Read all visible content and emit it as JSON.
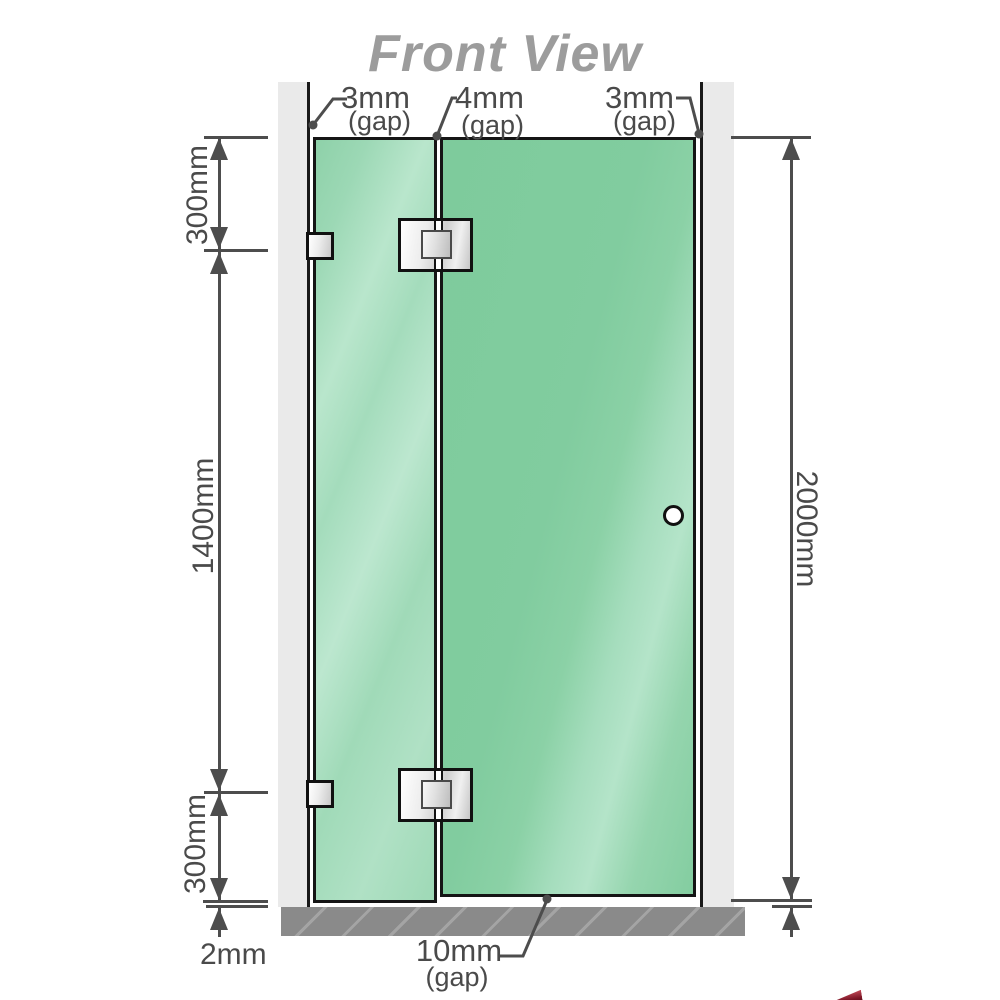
{
  "title": "Front View",
  "diagram": {
    "type": "shower-screen-front-elevation",
    "gaps": {
      "top_left": {
        "value": "3mm",
        "label": "(gap)"
      },
      "top_middle": {
        "value": "4mm",
        "label": "(gap)"
      },
      "top_right": {
        "value": "3mm",
        "label": "(gap)"
      },
      "bottom_door": {
        "value": "10mm",
        "label": "(gap)"
      }
    },
    "dimensions": {
      "left_top": "300mm",
      "left_middle": "1400mm",
      "left_bottom": "300mm",
      "floor_clearance_left": "2mm",
      "right_total_height": "2000mm"
    },
    "components": {
      "left_wall": "wall",
      "right_wall": "wall",
      "floor": "floor",
      "fixed_panel": "glass panel",
      "door_panel": "glass door",
      "door_knob": "round knob",
      "hinges": "glass-to-glass hinges (top & bottom)",
      "wall_brackets": "wall-to-glass brackets (top & bottom)"
    },
    "colors": {
      "glass_green": "#7fcb9c",
      "glass_green_light": "#b4e4c9",
      "wall_gray": "#eaeaea",
      "floor_gray": "#8a8a8a",
      "outline_black": "#151515",
      "dimension_gray": "#4a4a4a",
      "title_gray": "#9c9c9c",
      "hinge_silver": "#d8d8d8",
      "brand_red": "#7c1626"
    }
  }
}
